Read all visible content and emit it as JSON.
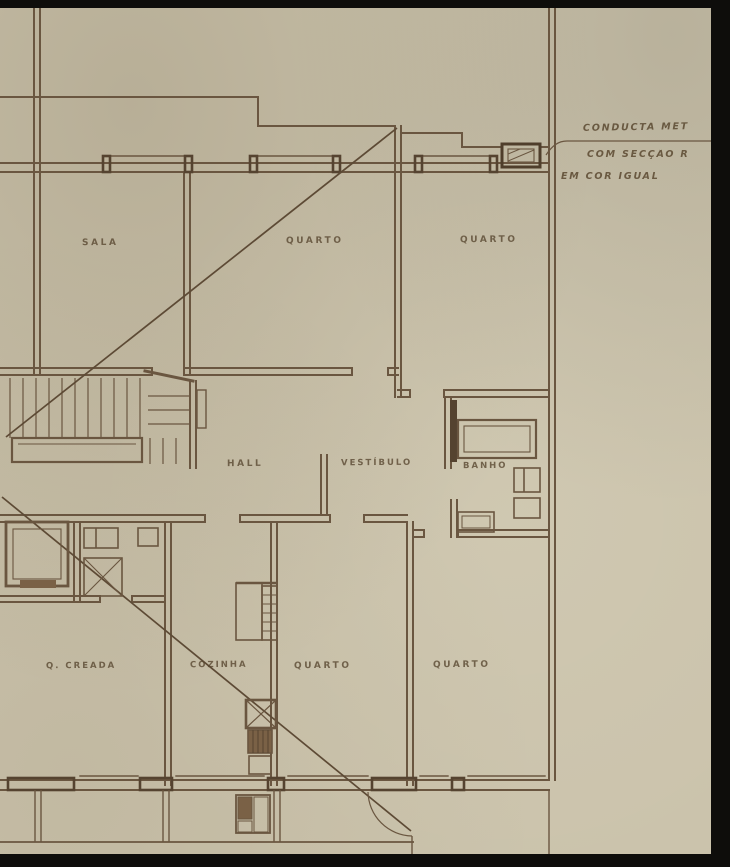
{
  "document": {
    "type": "architectural-floor-plan",
    "style": "hand-drawn sepia blueprint on aged paper"
  },
  "colors": {
    "paper": "#cac2ab",
    "ink": "#6a5640",
    "ink_dark": "#554330",
    "frame_black": "#0e0d0b",
    "hatch_fill": "#7a6146"
  },
  "rooms": {
    "sala": "SALA",
    "quarto_top_left": "QUARTO",
    "quarto_top_right": "QUARTO",
    "hall": "HALL",
    "vestibulo": "VESTÍBULO",
    "banho": "BANHO",
    "creada": "Q. CREADA",
    "cozinha": "COZINHA",
    "quarto_bottom_left": "QUARTO",
    "quarto_bottom_right": "QUARTO"
  },
  "annotations": {
    "line1": "CONDUCTA MET",
    "line2": "COM SECÇÃO R",
    "line3": "EM COR IGUAL",
    "target": "metal-duct-symbol"
  }
}
